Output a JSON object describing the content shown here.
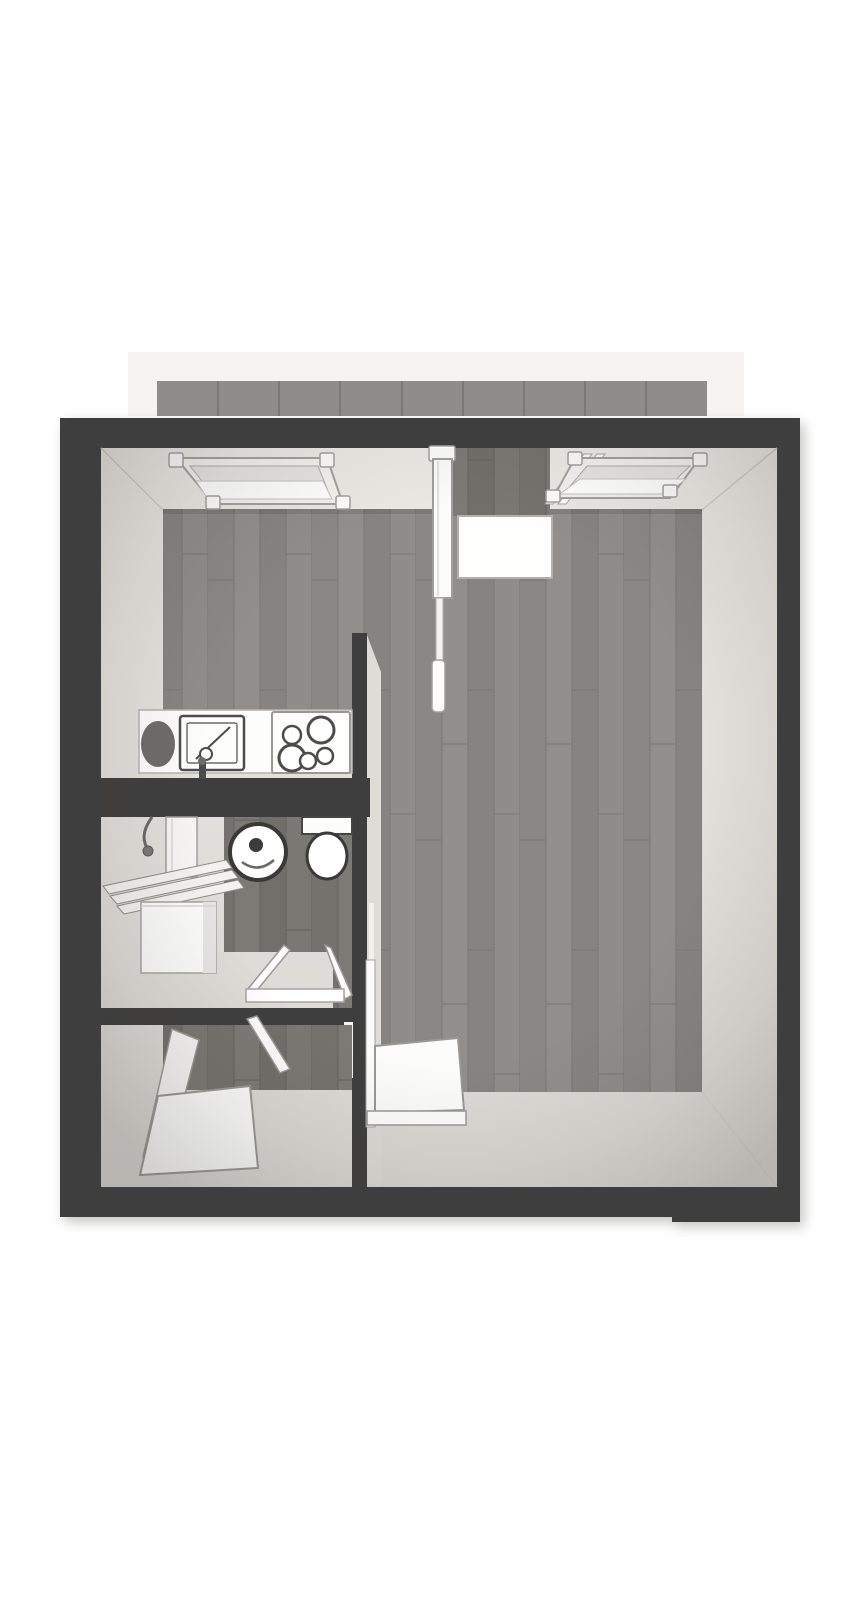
{
  "scene": {
    "title": "3D apartment floor plan render",
    "canvas_width": 867,
    "canvas_height": 1600
  },
  "colors": {
    "page_bg": "#ffffff",
    "outer_wall": "#3f3e3e",
    "interior_wall": "#3f3e3e",
    "wall_face_light": "#e9e7e2",
    "wall_face_shadow": "#dedcd7",
    "wood_floor": "#8d8b87",
    "wood_floor_dark": "#78766f",
    "balcony_backdrop": "#f5f4f2",
    "balcony_panel": "#8f8d8a",
    "balcony_panel_divider": "#7b7976",
    "fixture_white": "#fcfcfb",
    "fixture_stroke": "#9b9996",
    "dark_outline": "#393937",
    "sink_drainboard": "#6e6c6a"
  },
  "balcony": {
    "panel_count": 9
  },
  "rooms": [
    "balcony",
    "main-room",
    "kitchen-nook",
    "bathroom",
    "hallway"
  ],
  "fixtures": [
    "left-window",
    "right-window",
    "balcony-door",
    "balcony-door-threshold",
    "kitchen-counter",
    "drainboard",
    "kitchen-sink",
    "faucet",
    "cooktop",
    "shower-hose",
    "shower-screen",
    "bath-rack",
    "washing-machine",
    "washbasin",
    "toilet",
    "bathroom-door",
    "hallway-door",
    "entry-door",
    "main-room-door"
  ]
}
